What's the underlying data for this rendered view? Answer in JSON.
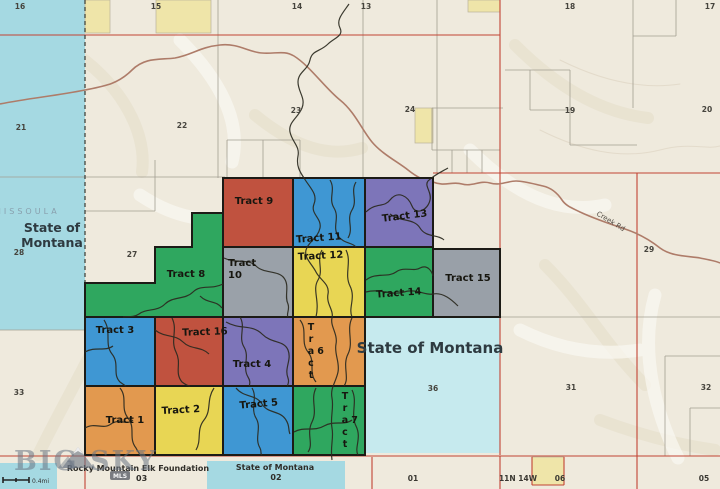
{
  "palette": {
    "terrain": "#efeadd",
    "water": "#a5d9e2",
    "water_light": "#c6eaee",
    "parcel_yellow": "#efe5a9",
    "tract_outline": "#1c1b16",
    "boundary_red": "#c24434",
    "section_gray": "#a39e91",
    "road_brown": "#ae7c69",
    "creek_dark": "#2b2a20"
  },
  "tracts": [
    {
      "label": "Tract 1",
      "color": "#e2994f"
    },
    {
      "label": "Tract 2",
      "color": "#e8d654"
    },
    {
      "label": "Tract 3",
      "color": "#3f97d3"
    },
    {
      "label": "Tract 4",
      "color": "#7d75b9"
    },
    {
      "label": "Tract 5",
      "color": "#3f97d3"
    },
    {
      "label": "Tract 6",
      "color": "#e2994f"
    },
    {
      "label": "Tract 7",
      "color": "#2fa75f"
    },
    {
      "label": "Tract 8",
      "color": "#2fa75f"
    },
    {
      "label": "Tract 9",
      "color": "#c0523f"
    },
    {
      "label": "Tract 10",
      "color": "#9aa1a9",
      "label_lines": [
        "Tract",
        "10"
      ]
    },
    {
      "label": "Tract 11",
      "color": "#3f97d3"
    },
    {
      "label": "Tract 12",
      "color": "#e8d654"
    },
    {
      "label": "Tract 13",
      "color": "#7d75b9"
    },
    {
      "label": "Tract 14",
      "color": "#2fa75f"
    },
    {
      "label": "Tract 15",
      "color": "#99a0a8"
    },
    {
      "label": "Tract 16",
      "color": "#c0523f"
    }
  ],
  "state_land": {
    "left_label_line1": "State of",
    "left_label_line2": "Montana",
    "right_label": "State of Montana",
    "right_section": "36"
  },
  "county_label": "MISSOULA",
  "road_label": "Creek Rd",
  "sections": [
    "16",
    "15",
    "14",
    "13",
    "18",
    "17",
    "21",
    "22",
    "23",
    "24",
    "19",
    "20",
    "28",
    "27",
    "29",
    "33",
    "31",
    "32"
  ],
  "bottom_bar": {
    "owner1": "Rocky Mountain Elk Foundation",
    "owner1_section": "03",
    "owner2": "State of Montana",
    "owner2_section": "02",
    "section_01": "01",
    "township": "11N 14W",
    "section_06": "06",
    "section_05": "05",
    "mls_badge": "MLS"
  },
  "logo": {
    "word1": "BIG",
    "word2": "SKY"
  },
  "scale_label": "0.4mi"
}
